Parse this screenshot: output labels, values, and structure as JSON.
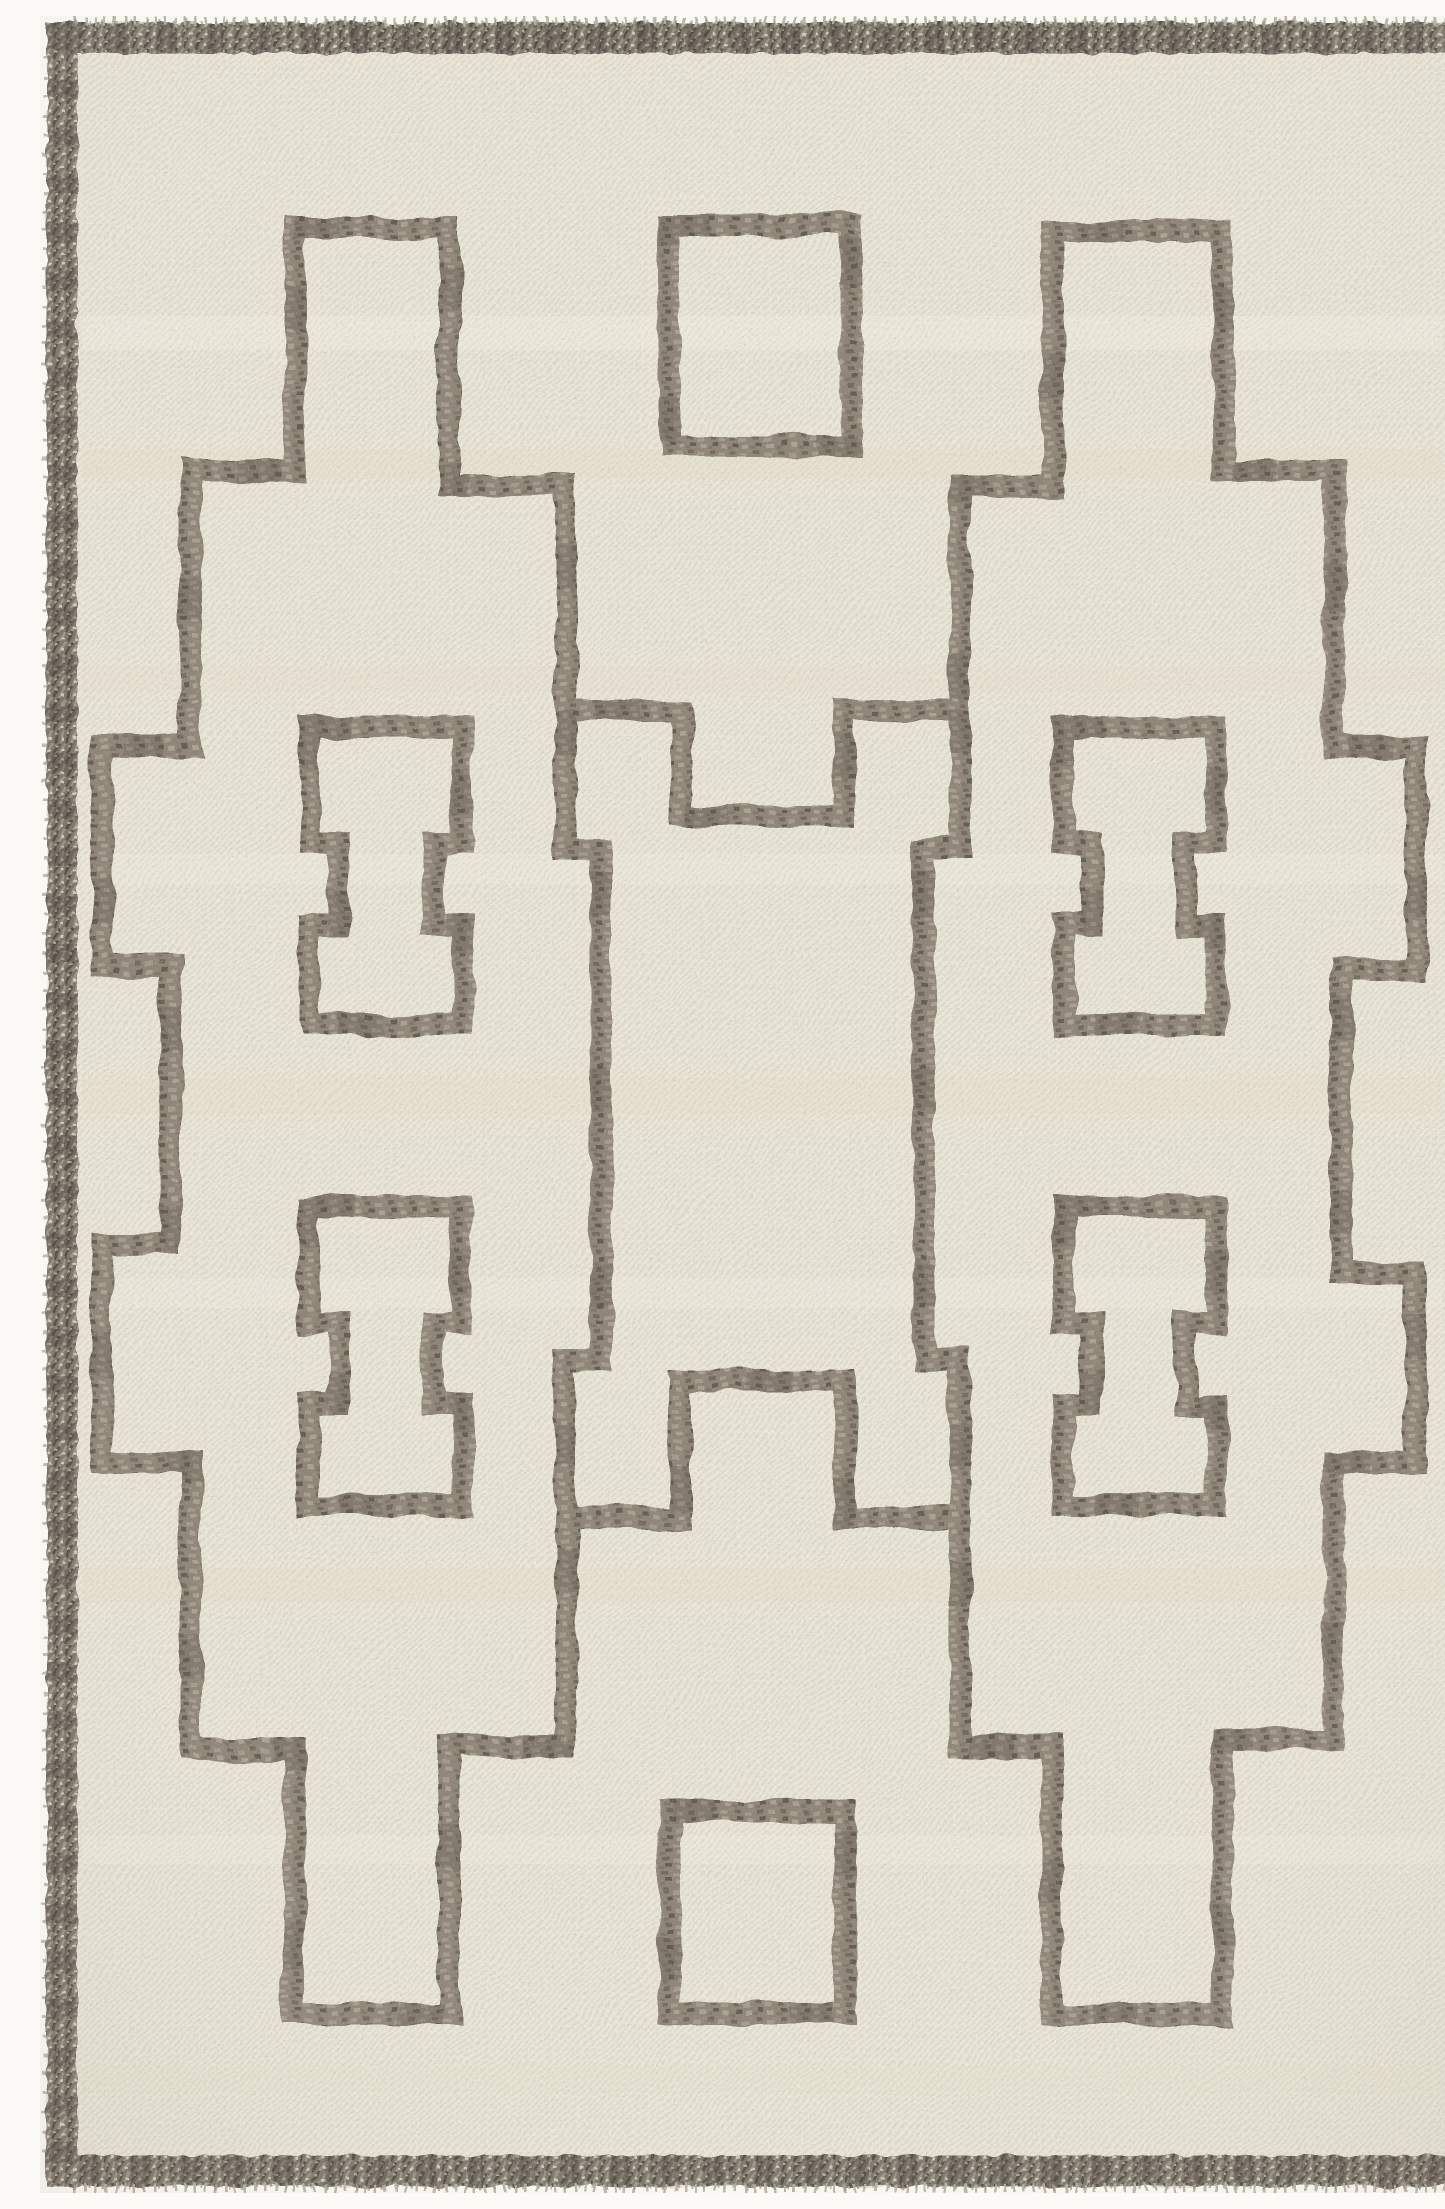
{
  "scene": {
    "type": "product-photo",
    "subject": "hand-woven flatweave wool kilim area rug, top-down flat view",
    "alt": "Cream ivory flatweave rug with taupe grey stepped geometric lattice pattern, two small squares, four bone-shaped motifs and a dark braided fringed border"
  },
  "palette": {
    "photo_background": "#fbfaf7",
    "rug_base": "#eae7dc",
    "weave_shadow": "#dfdacb",
    "weave_light": "#f3f1e8",
    "pattern_line": "#8d8579",
    "pattern_line_dark": "#58524a",
    "pattern_line_light": "#a9a196",
    "border_braid": "#7a746a",
    "border_fleck_dark": "#514c44",
    "border_fleck_light": "#d8d3c6",
    "fringe_light": "#b6b1a6",
    "fringe_mid": "#8b867c"
  },
  "rug": {
    "canvas": {
      "width": 1445,
      "height": 2177
    },
    "line_thickness": 22,
    "border": {
      "cl_x": 22,
      "cl_y": 22,
      "cl_w": 1401,
      "cl_h": 2133,
      "thickness": 31
    },
    "fringe": {
      "top_y": 5,
      "bottom_y": 2172,
      "left_x": 5,
      "right_x": 1440,
      "span_x1": 34,
      "span_x2": 1411,
      "span_y1": 42,
      "span_y2": 2136
    },
    "main_loop_points": [
      [
        254,
        211
      ],
      [
        409,
        211
      ],
      [
        409,
        470
      ],
      [
        525,
        470
      ],
      [
        525,
        695
      ],
      [
        640,
        695
      ],
      [
        640,
        800
      ],
      [
        805,
        800
      ],
      [
        805,
        695
      ],
      [
        920,
        695
      ],
      [
        920,
        470
      ],
      [
        1012,
        470
      ],
      [
        1012,
        215
      ],
      [
        1183,
        215
      ],
      [
        1183,
        454
      ],
      [
        1294,
        454
      ],
      [
        1294,
        730
      ],
      [
        1376,
        730
      ],
      [
        1376,
        954
      ],
      [
        1301,
        954
      ],
      [
        1301,
        1258
      ],
      [
        1376,
        1258
      ],
      [
        1376,
        1447
      ],
      [
        1294,
        1447
      ],
      [
        1294,
        1723
      ],
      [
        1183,
        1723
      ],
      [
        1183,
        1998
      ],
      [
        1012,
        1998
      ],
      [
        1012,
        1730
      ],
      [
        920,
        1730
      ],
      [
        920,
        1502
      ],
      [
        805,
        1502
      ],
      [
        805,
        1365
      ],
      [
        640,
        1365
      ],
      [
        640,
        1502
      ],
      [
        525,
        1502
      ],
      [
        525,
        1730
      ],
      [
        409,
        1730
      ],
      [
        409,
        1998
      ],
      [
        254,
        1998
      ],
      [
        254,
        1733
      ],
      [
        151,
        1733
      ],
      [
        151,
        1447
      ],
      [
        62,
        1447
      ],
      [
        62,
        1227
      ],
      [
        130,
        1227
      ],
      [
        130,
        950
      ],
      [
        62,
        950
      ],
      [
        62,
        730
      ],
      [
        151,
        730
      ],
      [
        151,
        454
      ],
      [
        254,
        454
      ]
    ],
    "brackets": [
      [
        [
          525,
          695
        ],
        [
          525,
          833
        ],
        [
          561,
          833
        ],
        [
          561,
          1344
        ],
        [
          525,
          1344
        ],
        [
          525,
          1502
        ]
      ],
      [
        [
          920,
          695
        ],
        [
          920,
          833
        ],
        [
          884,
          833
        ],
        [
          884,
          1344
        ],
        [
          920,
          1344
        ],
        [
          920,
          1502
        ]
      ]
    ],
    "squares": [
      {
        "x": 629,
        "y": 209,
        "w": 182,
        "h": 220
      },
      {
        "x": 629,
        "y": 1795,
        "w": 177,
        "h": 202
      }
    ],
    "dumbbells": [
      {
        "x": [
          269,
          422
        ],
        "nx": [
          299,
          393
        ],
        "y": [
          711,
          827,
          909,
          1009
        ]
      },
      {
        "x": [
          269,
          422
        ],
        "nx": [
          299,
          393
        ],
        "y": [
          1191,
          1307,
          1389,
          1489
        ]
      },
      {
        "x": [
          1023,
          1176
        ],
        "nx": [
          1052,
          1146
        ],
        "y": [
          711,
          827,
          909,
          1009
        ]
      },
      {
        "x": [
          1023,
          1176
        ],
        "nx": [
          1052,
          1146
        ],
        "y": [
          1191,
          1307,
          1389,
          1489
        ]
      }
    ],
    "weft_streaks": [
      {
        "y": 300,
        "h": 34,
        "c": "#f4f2e9",
        "o": 0.35
      },
      {
        "y": 433,
        "h": 30,
        "c": "#e2d9c6",
        "o": 0.3
      },
      {
        "y": 650,
        "h": 26,
        "c": "#e4dccb",
        "o": 0.22
      },
      {
        "y": 838,
        "h": 30,
        "c": "#f2efe5",
        "o": 0.3
      },
      {
        "y": 1062,
        "h": 36,
        "c": "#e3dbc9",
        "o": 0.25
      },
      {
        "y": 1262,
        "h": 30,
        "c": "#f3f0e7",
        "o": 0.3
      },
      {
        "y": 1552,
        "h": 34,
        "c": "#e4dcca",
        "o": 0.28
      },
      {
        "y": 1820,
        "h": 28,
        "c": "#f1eee4",
        "o": 0.3
      },
      {
        "y": 2050,
        "h": 26,
        "c": "#e5ddcc",
        "o": 0.22
      }
    ]
  }
}
